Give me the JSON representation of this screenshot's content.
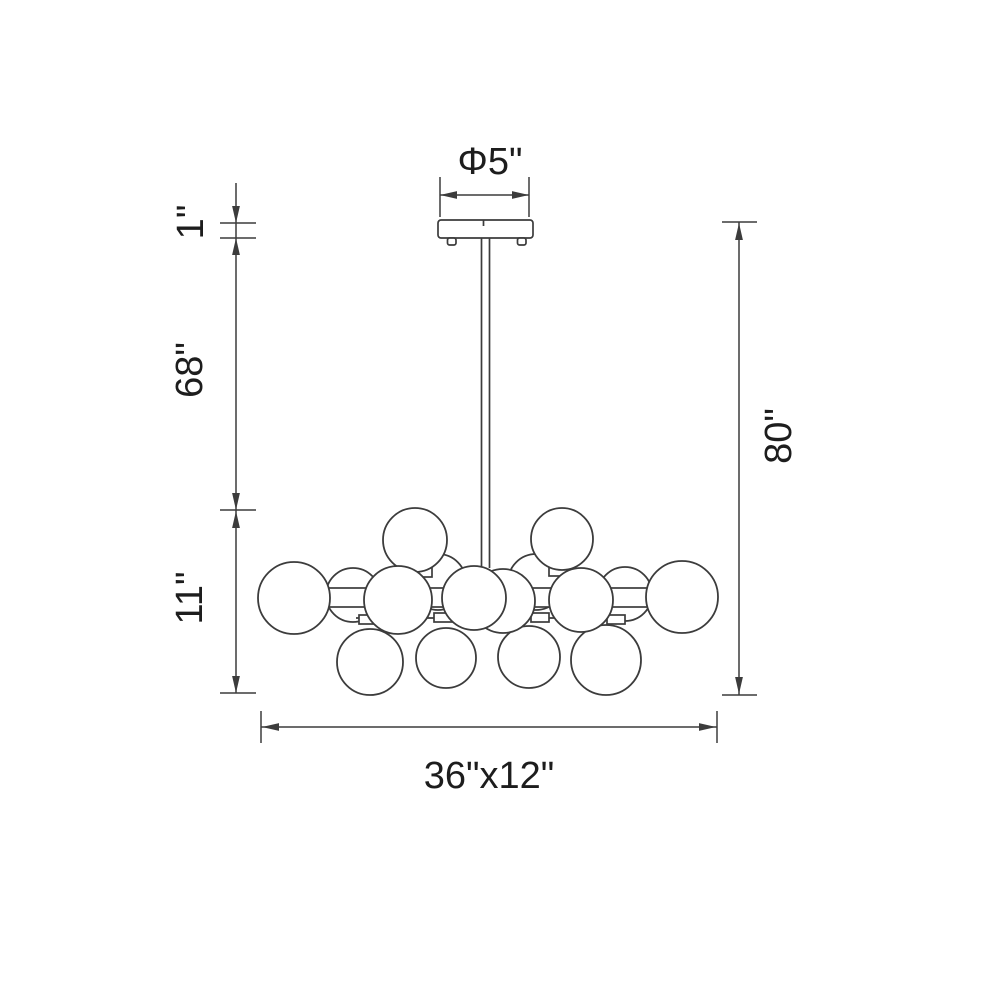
{
  "diagram": {
    "labels": {
      "canopy_diameter": "Φ5\"",
      "canopy_height": "1\"",
      "rod_length": "68\"",
      "fixture_height": "11\"",
      "overall_height": "80\"",
      "fixture_dimensions": "36\"x12\""
    },
    "colors": {
      "background": "#ffffff",
      "line": "#3c3c3c",
      "text": "#1d1d1d"
    },
    "geometry": {
      "canopy": {
        "x": 438,
        "y": 220,
        "w": 95,
        "h": 18,
        "rx": 3,
        "seam_x": 483.5,
        "feet": [
          {
            "x": 447.5,
            "y": 238,
            "w": 8.5,
            "h": 7
          },
          {
            "x": 517.5,
            "y": 238,
            "w": 8.5,
            "h": 7
          }
        ]
      },
      "rod": {
        "x": 481.5,
        "y": 238,
        "w": 8,
        "h": 330
      },
      "frame": {
        "upper_rail": {
          "x1": 386,
          "y": 572,
          "x2": 592
        },
        "band": {
          "x": 320,
          "y": 588,
          "w": 330,
          "h": 19
        },
        "lower_rail": {
          "x1": 356,
          "y": 618,
          "x2": 625
        },
        "top_necks": [
          {
            "x": 412,
            "y": 566,
            "w": 20,
            "h": 11
          },
          {
            "x": 549,
            "y": 565,
            "w": 20,
            "h": 11
          }
        ],
        "bottom_tabs": [
          {
            "x": 359,
            "y": 615,
            "w": 18,
            "h": 9
          },
          {
            "x": 434,
            "y": 613,
            "w": 18,
            "h": 9
          },
          {
            "x": 531,
            "y": 613,
            "w": 18,
            "h": 9
          },
          {
            "x": 607,
            "y": 615,
            "w": 18,
            "h": 9
          }
        ]
      },
      "globes": {
        "back": [
          {
            "cx": 353,
            "cy": 595,
            "r": 27
          },
          {
            "cx": 438,
            "cy": 582,
            "r": 28
          },
          {
            "cx": 536,
            "cy": 582,
            "r": 28
          },
          {
            "cx": 625,
            "cy": 594,
            "r": 27
          }
        ],
        "top": [
          {
            "cx": 415,
            "cy": 540,
            "r": 32
          },
          {
            "cx": 562,
            "cy": 539,
            "r": 31
          }
        ],
        "bottom": [
          {
            "cx": 370,
            "cy": 662,
            "r": 33
          },
          {
            "cx": 446,
            "cy": 658,
            "r": 30
          },
          {
            "cx": 529,
            "cy": 657,
            "r": 31
          },
          {
            "cx": 606,
            "cy": 660,
            "r": 35
          }
        ],
        "front": [
          {
            "cx": 294,
            "cy": 598,
            "r": 36
          },
          {
            "cx": 398,
            "cy": 600,
            "r": 34
          },
          {
            "cx": 503,
            "cy": 601,
            "r": 32
          },
          {
            "cx": 581,
            "cy": 600,
            "r": 32
          },
          {
            "cx": 682,
            "cy": 597,
            "r": 36
          },
          {
            "cx": 474,
            "cy": 598,
            "r": 32
          }
        ]
      },
      "dims": {
        "top": {
          "y": 195,
          "x1": 440,
          "x2": 529,
          "ext_y1": 177,
          "ext_y2": 217
        },
        "left": {
          "x": 236,
          "y1": 183,
          "y2": 693,
          "tick_x1": 220,
          "tick_x2": 256,
          "ticks": [
            223,
            238,
            510,
            693
          ],
          "arrows": [
            [
              "down",
              223
            ],
            [
              "up",
              238
            ],
            [
              "down",
              510
            ],
            [
              "up",
              511
            ],
            [
              "down",
              693
            ]
          ]
        },
        "right": {
          "x": 739,
          "y1": 222,
          "y2": 695,
          "tick_x1": 722,
          "tick_x2": 757,
          "ticks": [
            222,
            695
          ],
          "arrows": [
            [
              "up",
              223
            ],
            [
              "down",
              694
            ]
          ]
        },
        "bottom": {
          "y": 727,
          "x1": 261,
          "x2": 717,
          "tick_y1": 711,
          "tick_y2": 743,
          "ticks": [
            261,
            717
          ],
          "arrows": [
            [
              "left",
              262
            ],
            [
              "right",
              716
            ]
          ]
        }
      }
    }
  }
}
